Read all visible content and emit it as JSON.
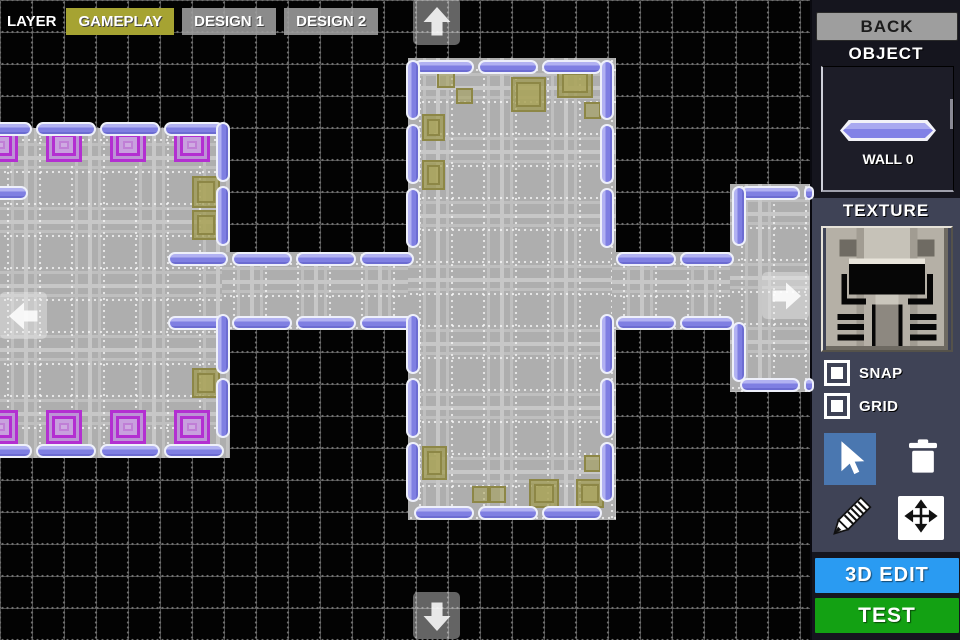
{
  "layer_bar": {
    "label": "LAYER",
    "tabs": [
      {
        "label": "GAMEPLAY",
        "active": true
      },
      {
        "label": "DESIGN 1",
        "active": false
      },
      {
        "label": "DESIGN 2",
        "active": false
      }
    ]
  },
  "sidebar": {
    "back_label": "BACK",
    "object": {
      "title": "OBJECT",
      "item_label": "WALL 0"
    },
    "texture": {
      "title": "TEXTURE"
    },
    "toggles": [
      {
        "label": "SNAP",
        "checked": true
      },
      {
        "label": "GRID",
        "checked": true
      }
    ],
    "tools": {
      "items": [
        "select",
        "delete",
        "draw",
        "move"
      ],
      "selected": "select"
    },
    "buttons": [
      {
        "label": "3D EDIT"
      },
      {
        "label": "TEST"
      }
    ]
  },
  "colors": {
    "active_tab": "#a6a332",
    "inactive_tab": "#9e9e9e",
    "wall": "#8181e6",
    "pad": "#b32fd1",
    "prop": "#8d8746",
    "edit3d_button": "#2a9bf2",
    "test_button": "#13a113",
    "tool_selected": "#4a77b0",
    "sidebar": "#3f4356",
    "panel_dark": "#15151e"
  },
  "map": {
    "floors": [
      {
        "x": -4,
        "y": 128,
        "w": 234,
        "h": 330
      },
      {
        "x": 222,
        "y": 252,
        "w": 196,
        "h": 78
      },
      {
        "x": 408,
        "y": 58,
        "w": 208,
        "h": 462
      },
      {
        "x": 612,
        "y": 252,
        "w": 130,
        "h": 78
      },
      {
        "x": 730,
        "y": 184,
        "w": 80,
        "h": 208
      }
    ],
    "walls_h": [
      {
        "x": -28,
        "y": 122,
        "len": 252
      },
      {
        "x": -28,
        "y": 186,
        "len": 56
      },
      {
        "x": -28,
        "y": 444,
        "len": 252
      },
      {
        "x": 168,
        "y": 252,
        "len": 246
      },
      {
        "x": 168,
        "y": 316,
        "len": 246
      },
      {
        "x": 414,
        "y": 60,
        "len": 192
      },
      {
        "x": 414,
        "y": 506,
        "len": 192
      },
      {
        "x": 616,
        "y": 252,
        "len": 118
      },
      {
        "x": 616,
        "y": 316,
        "len": 118
      },
      {
        "x": 740,
        "y": 186,
        "len": 74
      },
      {
        "x": 740,
        "y": 378,
        "len": 74
      }
    ],
    "walls_v": [
      {
        "x": 216,
        "y": 122,
        "len": 134
      },
      {
        "x": 216,
        "y": 314,
        "len": 134
      },
      {
        "x": 406,
        "y": 60,
        "len": 196
      },
      {
        "x": 406,
        "y": 314,
        "len": 196
      },
      {
        "x": 600,
        "y": 60,
        "len": 196
      },
      {
        "x": 600,
        "y": 314,
        "len": 196
      },
      {
        "x": 732,
        "y": 186,
        "len": 70
      },
      {
        "x": 732,
        "y": 322,
        "len": 60
      }
    ],
    "pads": [
      {
        "x": -18,
        "y": 128,
        "w": 36,
        "h": 34
      },
      {
        "x": 46,
        "y": 128,
        "w": 36,
        "h": 34
      },
      {
        "x": 110,
        "y": 128,
        "w": 36,
        "h": 34
      },
      {
        "x": 174,
        "y": 128,
        "w": 36,
        "h": 34
      },
      {
        "x": -18,
        "y": 410,
        "w": 36,
        "h": 34
      },
      {
        "x": 46,
        "y": 410,
        "w": 36,
        "h": 34
      },
      {
        "x": 110,
        "y": 410,
        "w": 36,
        "h": 34
      },
      {
        "x": 174,
        "y": 410,
        "w": 36,
        "h": 34
      }
    ],
    "props": [
      {
        "x": 192,
        "y": 176,
        "w": 28,
        "h": 32,
        "kind": "door"
      },
      {
        "x": 192,
        "y": 210,
        "w": 28,
        "h": 30,
        "kind": "door"
      },
      {
        "x": 192,
        "y": 368,
        "w": 28,
        "h": 30,
        "kind": "door"
      },
      {
        "x": 437,
        "y": 71,
        "w": 18,
        "h": 17,
        "kind": "sq"
      },
      {
        "x": 456,
        "y": 88,
        "w": 17,
        "h": 16,
        "kind": "sq"
      },
      {
        "x": 511,
        "y": 77,
        "w": 35,
        "h": 35,
        "kind": "box"
      },
      {
        "x": 557,
        "y": 68,
        "w": 36,
        "h": 30,
        "kind": "door"
      },
      {
        "x": 584,
        "y": 102,
        "w": 17,
        "h": 17,
        "kind": "sq"
      },
      {
        "x": 422,
        "y": 114,
        "w": 23,
        "h": 27,
        "kind": "door"
      },
      {
        "x": 422,
        "y": 160,
        "w": 23,
        "h": 30,
        "kind": "door"
      },
      {
        "x": 422,
        "y": 446,
        "w": 25,
        "h": 34,
        "kind": "door"
      },
      {
        "x": 472,
        "y": 486,
        "w": 17,
        "h": 17,
        "kind": "sq"
      },
      {
        "x": 489,
        "y": 486,
        "w": 17,
        "h": 17,
        "kind": "sq"
      },
      {
        "x": 529,
        "y": 479,
        "w": 30,
        "h": 29,
        "kind": "box"
      },
      {
        "x": 576,
        "y": 479,
        "w": 28,
        "h": 29,
        "kind": "box"
      },
      {
        "x": 584,
        "y": 455,
        "w": 17,
        "h": 17,
        "kind": "sq"
      }
    ]
  }
}
